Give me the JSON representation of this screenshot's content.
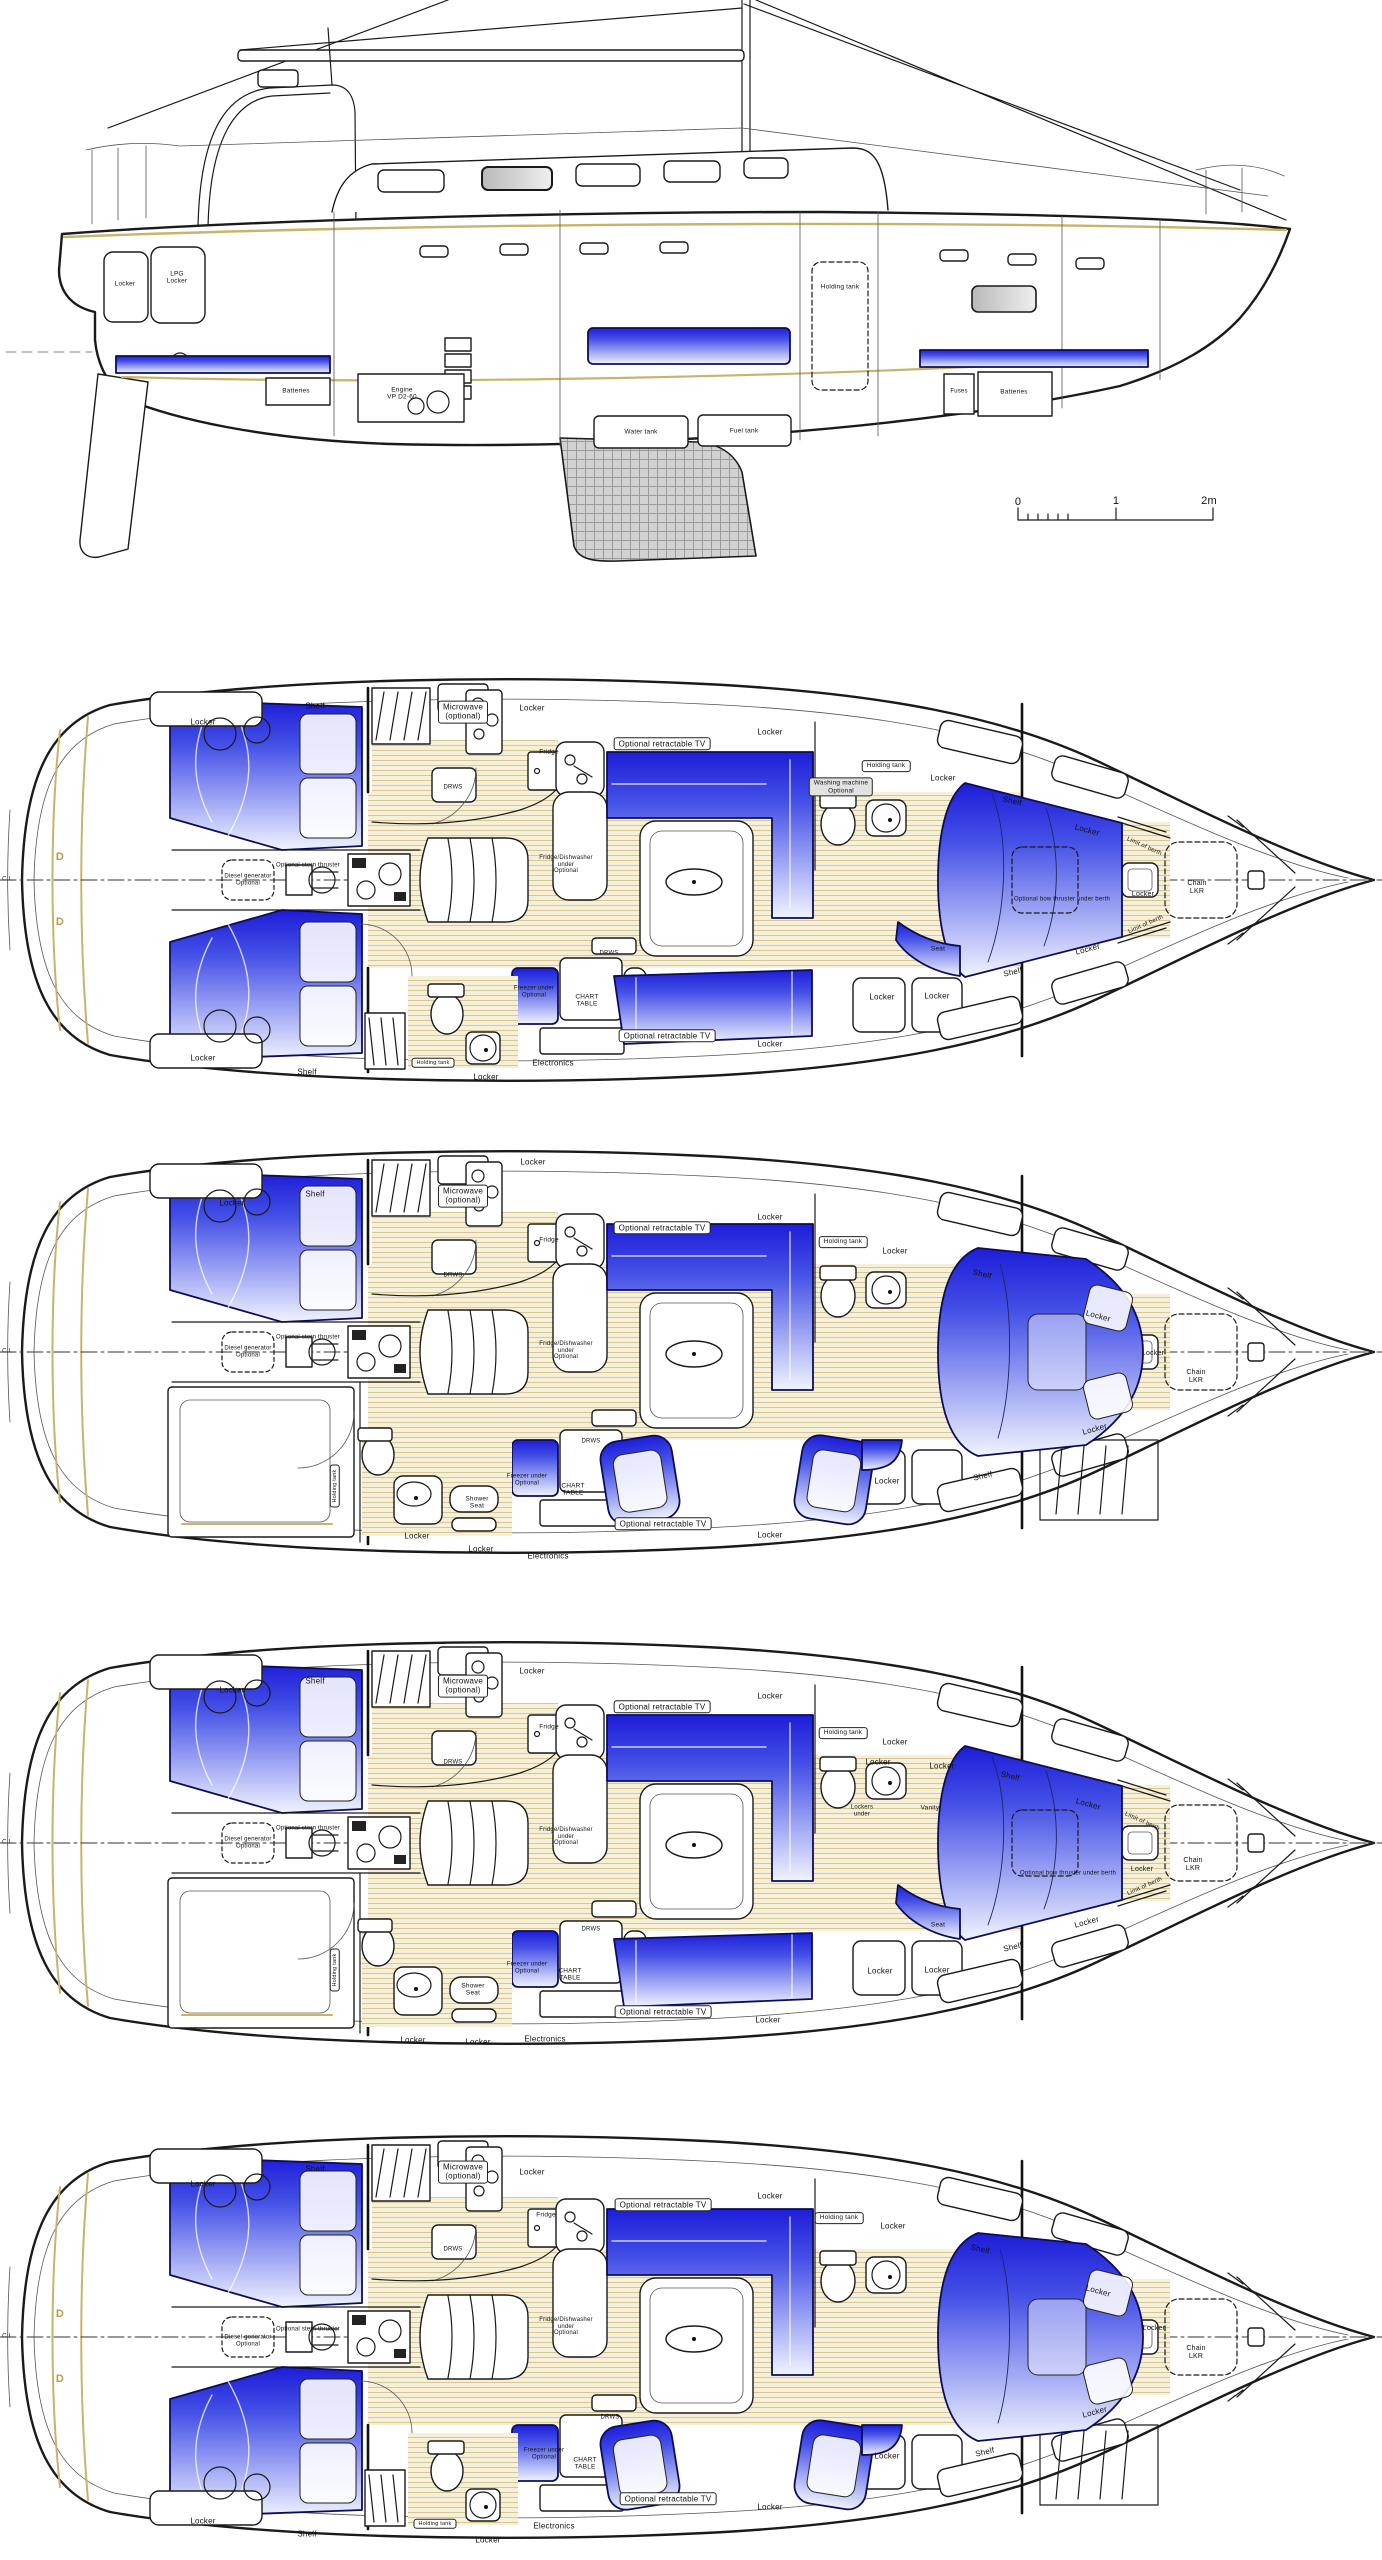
{
  "colors": {
    "berth_blue": "#1d1dd8",
    "wood_floor": "#f6f0d8",
    "accent_tan": "#c9b36a",
    "line": "#1a1a1a"
  },
  "views": [
    {
      "name": "side-profile",
      "top": 0,
      "labels": [
        {
          "t": "Locker",
          "x": 125,
          "y": 284,
          "s": 6.5
        },
        {
          "t": "LPG\nLocker",
          "x": 177,
          "y": 278,
          "s": 6.5
        },
        {
          "t": "Batteries",
          "x": 296,
          "y": 391,
          "s": 6.5
        },
        {
          "t": "Engine\nVP D2-60",
          "x": 402,
          "y": 394,
          "s": 6.5
        },
        {
          "t": "Water tank",
          "x": 641,
          "y": 432,
          "s": 6.5
        },
        {
          "t": "Fuel tank",
          "x": 744,
          "y": 431,
          "s": 6.5
        },
        {
          "t": "Holding tank",
          "x": 840,
          "y": 287,
          "s": 6.5
        },
        {
          "t": "Fuses",
          "x": 959,
          "y": 392,
          "s": 6
        },
        {
          "t": "Batteries",
          "x": 1014,
          "y": 392,
          "s": 6.5
        },
        {
          "t": "0",
          "x": 1018,
          "y": 502,
          "s": 11
        },
        {
          "t": "1",
          "x": 1116,
          "y": 501,
          "s": 11
        },
        {
          "t": "2m",
          "x": 1209,
          "y": 501,
          "s": 11
        }
      ]
    },
    {
      "name": "deck-plan-1",
      "top": 660,
      "labels": [
        {
          "t": "C.L.",
          "x": 8,
          "y": 220,
          "s": 6
        },
        {
          "t": "D",
          "x": 60,
          "y": 197,
          "s": 11,
          "c": "#b89a4a"
        },
        {
          "t": "D",
          "x": 60,
          "y": 262,
          "s": 11,
          "c": "#b89a4a"
        },
        {
          "t": "Locker",
          "x": 203,
          "y": 63
        },
        {
          "t": "Shelf",
          "x": 315,
          "y": 47
        },
        {
          "t": "Microwave\n(optional)",
          "x": 463,
          "y": 52,
          "b": 1
        },
        {
          "t": "Locker",
          "x": 532,
          "y": 49
        },
        {
          "t": "Optional retractable TV",
          "x": 662,
          "y": 84,
          "b": 1
        },
        {
          "t": "Locker",
          "x": 770,
          "y": 73
        },
        {
          "t": "Washing machine\nOptional",
          "x": 841,
          "y": 127,
          "s": 6.5,
          "b": 1,
          "g": 1
        },
        {
          "t": "Holding tank",
          "x": 886,
          "y": 106,
          "s": 6.5,
          "b": 1
        },
        {
          "t": "Locker",
          "x": 943,
          "y": 119
        },
        {
          "t": "Shelf",
          "x": 1012,
          "y": 142,
          "r": 13
        },
        {
          "t": "Locker",
          "x": 1087,
          "y": 171,
          "r": 15
        },
        {
          "t": "Limit of berth",
          "x": 1144,
          "y": 187,
          "r": 24,
          "s": 6
        },
        {
          "t": "Chain\nLKR",
          "x": 1197,
          "y": 228,
          "s": 7
        },
        {
          "t": "Locker",
          "x": 1143,
          "y": 235,
          "s": 7
        },
        {
          "t": "Optional bow thruster under berth",
          "x": 1062,
          "y": 240,
          "s": 6
        },
        {
          "t": "Seat",
          "x": 938,
          "y": 289,
          "s": 6.5
        },
        {
          "t": "Locker",
          "x": 1088,
          "y": 290,
          "r": -15
        },
        {
          "t": "Shelf",
          "x": 1013,
          "y": 313,
          "r": -13
        },
        {
          "t": "Limit of berth",
          "x": 1146,
          "y": 265,
          "r": -24,
          "s": 6
        },
        {
          "t": "Locker",
          "x": 882,
          "y": 338
        },
        {
          "t": "Locker",
          "x": 937,
          "y": 337
        },
        {
          "t": "DRWS",
          "x": 453,
          "y": 128,
          "s": 6
        },
        {
          "t": "Optional stern thruster",
          "x": 308,
          "y": 206,
          "s": 6
        },
        {
          "t": "Diesel generator\nOptional",
          "x": 248,
          "y": 220,
          "s": 6
        },
        {
          "t": "Fridge",
          "x": 549,
          "y": 92,
          "s": 6.5
        },
        {
          "t": "Fridge/Dishwasher\nunder\nOptional",
          "x": 566,
          "y": 205,
          "s": 6
        },
        {
          "t": "DRWS",
          "x": 609,
          "y": 294,
          "s": 6
        },
        {
          "t": "CHART\nTABLE",
          "x": 587,
          "y": 341,
          "s": 6.5
        },
        {
          "t": "Freezer under\nOptional",
          "x": 534,
          "y": 332,
          "s": 6
        },
        {
          "t": "Optional retractable TV",
          "x": 667,
          "y": 376,
          "b": 1
        },
        {
          "t": "Locker",
          "x": 770,
          "y": 385
        },
        {
          "t": "Electronics",
          "x": 553,
          "y": 404
        },
        {
          "t": "Locker",
          "x": 486,
          "y": 418
        },
        {
          "t": "Locker",
          "x": 203,
          "y": 399
        },
        {
          "t": "Shelf",
          "x": 307,
          "y": 413
        },
        {
          "t": "Holding tank",
          "x": 433,
          "y": 403,
          "s": 5.5,
          "b": 1
        }
      ]
    },
    {
      "name": "deck-plan-2",
      "top": 1110,
      "labels": [
        {
          "t": "C.L.",
          "x": 8,
          "y": 242,
          "s": 6
        },
        {
          "t": "Locker",
          "x": 232,
          "y": 94
        },
        {
          "t": "Sh",
          "x": -100,
          "y": -100,
          "s": 1
        },
        {
          "t": "Shelf",
          "x": 315,
          "y": 85
        },
        {
          "t": "Microwave\n(optional)",
          "x": 463,
          "y": 86,
          "b": 1
        },
        {
          "t": "Locker",
          "x": 533,
          "y": 53
        },
        {
          "t": "Optional retractable TV",
          "x": 662,
          "y": 118,
          "b": 1
        },
        {
          "t": "Locker",
          "x": 770,
          "y": 108
        },
        {
          "t": "Holding tank",
          "x": 843,
          "y": 132,
          "s": 6.5,
          "b": 1
        },
        {
          "t": "Locker",
          "x": 895,
          "y": 142
        },
        {
          "t": "Shelf",
          "x": 982,
          "y": 165,
          "r": 13
        },
        {
          "t": "Locker",
          "x": 1098,
          "y": 207,
          "r": 15
        },
        {
          "t": "Locker",
          "x": 1153,
          "y": 244,
          "s": 7
        },
        {
          "t": "Chain\nLKR",
          "x": 1196,
          "y": 267,
          "s": 7
        },
        {
          "t": "Locker",
          "x": 1095,
          "y": 320,
          "r": -15
        },
        {
          "t": "Shelf",
          "x": 983,
          "y": 367,
          "r": -13
        },
        {
          "t": "Locker",
          "x": 887,
          "y": 372
        },
        {
          "t": "DRWS",
          "x": 453,
          "y": 166,
          "s": 6
        },
        {
          "t": "Optional stern thruster",
          "x": 308,
          "y": 228,
          "s": 6
        },
        {
          "t": "Diesel generator\nOptional",
          "x": 248,
          "y": 242,
          "s": 6
        },
        {
          "t": "Fridge",
          "x": 549,
          "y": 130,
          "s": 6.5
        },
        {
          "t": "Fridge/Dishwasher\nunder\nOptional",
          "x": 566,
          "y": 241,
          "s": 6
        },
        {
          "t": "Holding tank",
          "x": 335,
          "y": 376,
          "r": -90,
          "s": 5.5,
          "b": 1
        },
        {
          "t": "Shower\nSeat",
          "x": 477,
          "y": 393,
          "s": 6.5
        },
        {
          "t": "Locker",
          "x": 417,
          "y": 427
        },
        {
          "t": "DRWS",
          "x": 591,
          "y": 332,
          "s": 6
        },
        {
          "t": "CHART\nTABLE",
          "x": 573,
          "y": 380,
          "s": 6.5
        },
        {
          "t": "Freezer under\nOptional",
          "x": 527,
          "y": 370,
          "s": 6
        },
        {
          "t": "Optional retractable TV",
          "x": 663,
          "y": 414,
          "b": 1
        },
        {
          "t": "Locker",
          "x": 770,
          "y": 426
        },
        {
          "t": "Electronics",
          "x": 548,
          "y": 447
        },
        {
          "t": "Locker",
          "x": 481,
          "y": 440
        }
      ]
    },
    {
      "name": "deck-plan-3",
      "top": 1600,
      "labels": [
        {
          "t": "C.L.",
          "x": 8,
          "y": 243,
          "s": 6
        },
        {
          "t": "Locker",
          "x": 232,
          "y": 91
        },
        {
          "t": "Shelf",
          "x": 315,
          "y": 82
        },
        {
          "t": "Microwave\n(optional)",
          "x": 463,
          "y": 86,
          "b": 1
        },
        {
          "t": "Locker",
          "x": 532,
          "y": 72
        },
        {
          "t": "Optional retractable TV",
          "x": 662,
          "y": 107,
          "b": 1
        },
        {
          "t": "Locker",
          "x": 770,
          "y": 97
        },
        {
          "t": "Holding tank",
          "x": 843,
          "y": 133,
          "s": 6.5,
          "b": 1
        },
        {
          "t": "Locker",
          "x": 895,
          "y": 143
        },
        {
          "t": "Locker",
          "x": 878,
          "y": 163
        },
        {
          "t": "Locker",
          "x": 942,
          "y": 167
        },
        {
          "t": "Lockers\nunder",
          "x": 862,
          "y": 211,
          "s": 6
        },
        {
          "t": "Vanity",
          "x": 930,
          "y": 208,
          "s": 6.5
        },
        {
          "t": "Shelf",
          "x": 1010,
          "y": 177,
          "r": 13
        },
        {
          "t": "Locker",
          "x": 1088,
          "y": 205,
          "r": 15
        },
        {
          "t": "Limit of berth",
          "x": 1142,
          "y": 222,
          "r": 24,
          "s": 6
        },
        {
          "t": "Chain\nLKR",
          "x": 1193,
          "y": 265,
          "s": 7
        },
        {
          "t": "Locker",
          "x": 1142,
          "y": 270,
          "s": 7
        },
        {
          "t": "Optional bow thruster under berth",
          "x": 1068,
          "y": 274,
          "s": 6
        },
        {
          "t": "Seat",
          "x": 938,
          "y": 325,
          "s": 6.5
        },
        {
          "t": "Locker",
          "x": 1087,
          "y": 323,
          "r": -15
        },
        {
          "t": "Shelf",
          "x": 1013,
          "y": 348,
          "r": -13
        },
        {
          "t": "Limit of berth",
          "x": 1145,
          "y": 287,
          "r": -24,
          "s": 6
        },
        {
          "t": "Locker",
          "x": 880,
          "y": 372
        },
        {
          "t": "Locker",
          "x": 937,
          "y": 371
        },
        {
          "t": "DRWS",
          "x": 453,
          "y": 163,
          "s": 6
        },
        {
          "t": "Optional stern thruster",
          "x": 308,
          "y": 229,
          "s": 6
        },
        {
          "t": "Diesel generator\nOptional",
          "x": 248,
          "y": 243,
          "s": 6
        },
        {
          "t": "Fridge",
          "x": 549,
          "y": 127,
          "s": 6.5
        },
        {
          "t": "Fridge/Dishwasher\nunder\nOptional",
          "x": 566,
          "y": 237,
          "s": 6
        },
        {
          "t": "Holding tank",
          "x": 335,
          "y": 370,
          "r": -90,
          "s": 5.5,
          "b": 1
        },
        {
          "t": "Shower\nSeat",
          "x": 473,
          "y": 390,
          "s": 6.5
        },
        {
          "t": "Locker",
          "x": 413,
          "y": 441
        },
        {
          "t": "Locker",
          "x": 478,
          "y": 443
        },
        {
          "t": "DRWS",
          "x": 591,
          "y": 330,
          "s": 6
        },
        {
          "t": "CHART\nTABLE",
          "x": 570,
          "y": 375,
          "s": 6.5
        },
        {
          "t": "Freezer under\nOptional",
          "x": 527,
          "y": 368,
          "s": 6
        },
        {
          "t": "Optional retractable TV",
          "x": 663,
          "y": 412,
          "b": 1
        },
        {
          "t": "Locker",
          "x": 768,
          "y": 421
        },
        {
          "t": "Electronics",
          "x": 545,
          "y": 440
        }
      ]
    },
    {
      "name": "deck-plan-4",
      "top": 2090,
      "labels": [
        {
          "t": "C.L.",
          "x": 8,
          "y": 247,
          "s": 6
        },
        {
          "t": "D",
          "x": 60,
          "y": 224,
          "s": 11,
          "c": "#b89a4a"
        },
        {
          "t": "D",
          "x": 60,
          "y": 289,
          "s": 11,
          "c": "#b89a4a"
        },
        {
          "t": "Locker",
          "x": 203,
          "y": 95
        },
        {
          "t": "Shelf",
          "x": 315,
          "y": 80
        },
        {
          "t": "Microwave\n(optional)",
          "x": 463,
          "y": 82,
          "b": 1
        },
        {
          "t": "Locker",
          "x": 532,
          "y": 83
        },
        {
          "t": "Optional retractable TV",
          "x": 663,
          "y": 115,
          "b": 1
        },
        {
          "t": "Locker",
          "x": 770,
          "y": 107
        },
        {
          "t": "Holding tank",
          "x": 839,
          "y": 128,
          "s": 6.5,
          "b": 1
        },
        {
          "t": "Locker",
          "x": 893,
          "y": 137
        },
        {
          "t": "Shelf",
          "x": 980,
          "y": 160,
          "r": 13
        },
        {
          "t": "Locker",
          "x": 1098,
          "y": 202,
          "r": 15
        },
        {
          "t": "Locker",
          "x": 1154,
          "y": 239,
          "s": 7
        },
        {
          "t": "Chain\nLKR",
          "x": 1196,
          "y": 263,
          "s": 7
        },
        {
          "t": "Locker",
          "x": 1095,
          "y": 323,
          "r": -15
        },
        {
          "t": "Shelf",
          "x": 985,
          "y": 363,
          "r": -13
        },
        {
          "t": "Locker",
          "x": 887,
          "y": 367
        },
        {
          "t": "DRWS",
          "x": 453,
          "y": 160,
          "s": 6
        },
        {
          "t": "Optional stern thruster",
          "x": 308,
          "y": 240,
          "s": 6
        },
        {
          "t": "Diesel generator\nOptional",
          "x": 248,
          "y": 251,
          "s": 6
        },
        {
          "t": "Fridge",
          "x": 546,
          "y": 125,
          "s": 6.5
        },
        {
          "t": "Fridge/Dishwasher\nunder\nOptional",
          "x": 566,
          "y": 237,
          "s": 6
        },
        {
          "t": "DRWS",
          "x": 610,
          "y": 328,
          "s": 6
        },
        {
          "t": "CHART\nTABLE",
          "x": 585,
          "y": 374,
          "s": 6.5
        },
        {
          "t": "Freezer under\nOptional",
          "x": 544,
          "y": 364,
          "s": 6
        },
        {
          "t": "Optional retractable TV",
          "x": 668,
          "y": 409,
          "b": 1
        },
        {
          "t": "Locker",
          "x": 770,
          "y": 418
        },
        {
          "t": "Electronics",
          "x": 554,
          "y": 437
        },
        {
          "t": "Locker",
          "x": 488,
          "y": 451
        },
        {
          "t": "Locker",
          "x": 203,
          "y": 432
        },
        {
          "t": "Shelf",
          "x": 307,
          "y": 445
        },
        {
          "t": "Holding tank",
          "x": 435,
          "y": 434,
          "s": 5.5,
          "b": 1
        }
      ]
    }
  ]
}
